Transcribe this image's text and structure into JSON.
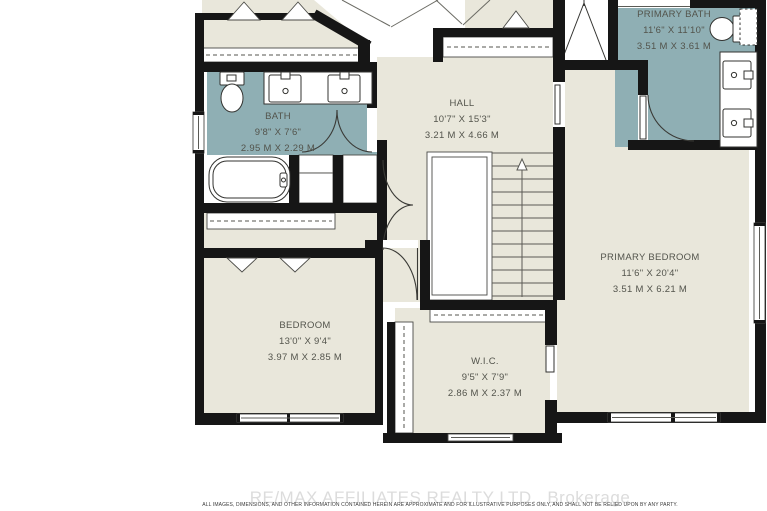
{
  "plan": {
    "rooms": [
      {
        "id": "bath",
        "name": "BATH",
        "imperial": "9'8\" X 7'6\"",
        "metric": "2.95 M X 2.29 M"
      },
      {
        "id": "hall",
        "name": "HALL",
        "imperial": "10'7\" X 15'3\"",
        "metric": "3.21 M X 4.66 M"
      },
      {
        "id": "primary-bath",
        "name": "PRIMARY BATH",
        "imperial": "11'6\" X 11'10\"",
        "metric": "3.51 M X 3.61 M"
      },
      {
        "id": "primary-bedroom",
        "name": "PRIMARY BEDROOM",
        "imperial": "11'6\" X 20'4\"",
        "metric": "3.51 M X 6.21 M"
      },
      {
        "id": "bedroom",
        "name": "BEDROOM",
        "imperial": "13'0\" X 9'4\"",
        "metric": "3.97 M X 2.85 M"
      },
      {
        "id": "wic",
        "name": "W.I.C.",
        "imperial": "9'5\" X 7'9\"",
        "metric": "2.86 M X 2.37 M"
      }
    ],
    "stairs": {
      "arrow": "up-arrow"
    },
    "colors": {
      "floor": "#E9E7DB",
      "wet_area": "#8FAFB4",
      "wall": "#161616"
    }
  },
  "footer": {
    "watermark": "RE/MAX AFFILIATES REALTY LTD.,  Brokerage",
    "disclaimer": "ALL IMAGES, DIMENSIONS, AND OTHER INFORMATION CONTAINED HEREIN ARE APPROXIMATE AND FOR ILLUSTRATIVE PURPOSES ONLY, AND SHALL NOT BE RELIED UPON BY ANY PARTY."
  }
}
